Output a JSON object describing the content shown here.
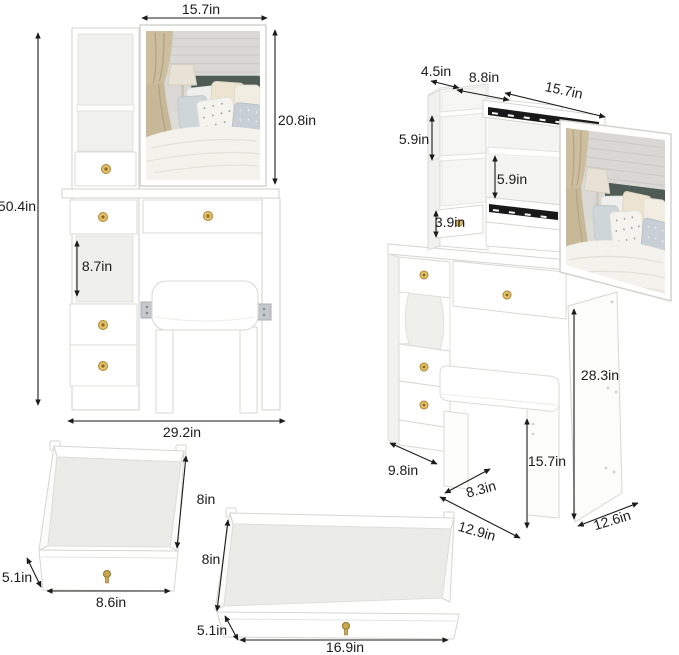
{
  "front_view": {
    "mirror_width": "15.7in",
    "mirror_height": "20.8in",
    "total_height": "50.4in",
    "open_shelf_height": "8.7in",
    "total_width": "29.2in"
  },
  "side_view": {
    "top_shelf_depth": "4.5in",
    "top_shelf_width": "8.8in",
    "sliding_mirror_width": "15.7in",
    "upper_shelf_height": "5.9in",
    "middle_shelf_height": "5.9in",
    "small_drawer_height": "3.9in",
    "desk_side_height": "28.3in",
    "lower_cabinet_depth": "9.8in",
    "stool_seat_depth": "8.3in",
    "stool_height": "15.7in",
    "cabinet_front_width": "12.9in",
    "side_panel_depth": "12.6in"
  },
  "small_drawer_detail": {
    "depth": "8in",
    "height": "5.1in",
    "width": "8.6in"
  },
  "wide_drawer_detail": {
    "depth": "8in",
    "height": "5.1in",
    "width": "16.9in"
  },
  "colors": {
    "background": "#ffffff",
    "furniture_outline": "#d6d6d3",
    "interior_shade": "#efefec",
    "knob_brass": "#d2ab52",
    "rail_black": "#191919",
    "headboard_teal": "#4e5c55",
    "dimension_text": "#1b1b1b"
  }
}
